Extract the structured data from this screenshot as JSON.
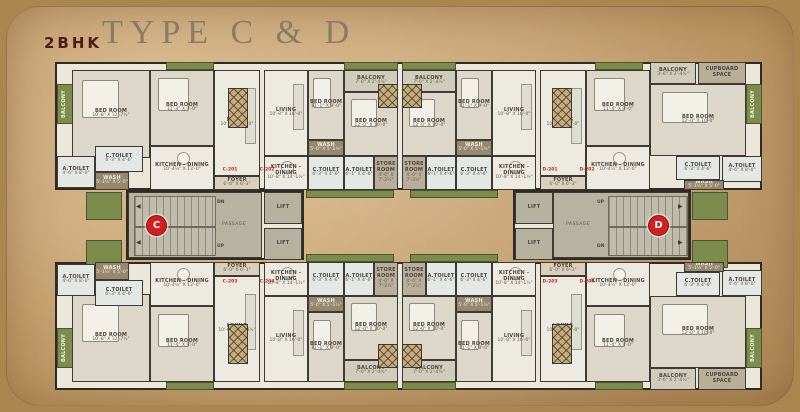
{
  "header": {
    "bhk": "2BHK",
    "type_title": "TYPE C & D"
  },
  "colors": {
    "paper": "#cba878",
    "wall": "#3e3933",
    "green": "#7c8c4c",
    "badge_red": "#d21f1f",
    "flat_red": "#c0241e",
    "title_maroon": "#4d1d14",
    "title_serif": "#8b7a66"
  },
  "plan": {
    "lift_label": "LIFT",
    "slabs": [
      {
        "x": 55,
        "y": 62,
        "w": 707,
        "h": 128
      },
      {
        "x": 55,
        "y": 262,
        "w": 707,
        "h": 128
      },
      {
        "x": 126,
        "y": 190,
        "w": 178,
        "h": 70
      },
      {
        "x": 513,
        "y": 190,
        "w": 178,
        "h": 70
      }
    ],
    "rooms": [
      {
        "type": "balcony-v",
        "label": "BALCONY",
        "dims": "3'-6\" X 1'-10½\"",
        "x": 57,
        "y": 84,
        "w": 16,
        "h": 40
      },
      {
        "type": "bed",
        "label": "BED ROOM",
        "dims": "10'-8\" X 12'-7½\"",
        "x": 72,
        "y": 70,
        "w": 78,
        "h": 88
      },
      {
        "type": "bed",
        "label": "BED ROOM",
        "dims": "11'-4\" X 9'-0\"",
        "x": 150,
        "y": 70,
        "w": 64,
        "h": 76
      },
      {
        "type": "living",
        "label": "LIVING",
        "dims": "10'-8\" X 16'-0\"",
        "x": 214,
        "y": 70,
        "w": 46,
        "h": 106
      },
      {
        "type": "toilet",
        "label": "A.TOILET",
        "dims": "4'-6\" X 8'-0\"",
        "x": 57,
        "y": 156,
        "w": 38,
        "h": 32
      },
      {
        "type": "toilet",
        "label": "C.TOILET",
        "dims": "6'-3\" X 4'-6\"",
        "x": 95,
        "y": 146,
        "w": 48,
        "h": 26
      },
      {
        "type": "wash",
        "label": "WASH",
        "dims": "5'-1½\" X 5'-0\"",
        "x": 95,
        "y": 172,
        "w": 34,
        "h": 18
      },
      {
        "type": "kitchen",
        "label": "KITCHEN - DINING",
        "dims": "10'-4½\" X 13'-0\"",
        "x": 150,
        "y": 146,
        "w": 64,
        "h": 44
      },
      {
        "type": "foyer",
        "label": "FOYER",
        "dims": "6'-0\" X 6'-3\"",
        "x": 214,
        "y": 176,
        "w": 46,
        "h": 14
      },
      {
        "type": "living",
        "label": "LIVING",
        "dims": "10'-8\" X 16'-0\"",
        "x": 264,
        "y": 70,
        "w": 44,
        "h": 86
      },
      {
        "type": "bed",
        "label": "BED ROOM",
        "dims": "11'-1\" X 9'-0\"",
        "x": 308,
        "y": 70,
        "w": 36,
        "h": 70
      },
      {
        "type": "wash",
        "label": "WASH",
        "dims": "5'-0\" X 5'-1½\"",
        "x": 308,
        "y": 140,
        "w": 36,
        "h": 16
      },
      {
        "type": "balcony",
        "label": "BALCONY",
        "dims": "7'-0\" X 2'-4½\"",
        "x": 344,
        "y": 70,
        "w": 54,
        "h": 22
      },
      {
        "type": "bed",
        "label": "BED ROOM",
        "dims": "12'-0\" X 10'-0\"",
        "x": 344,
        "y": 92,
        "w": 54,
        "h": 64
      },
      {
        "type": "kitchen",
        "label": "KITCHEN - DINING",
        "dims": "10'-8\" X 14'-1½\"",
        "x": 264,
        "y": 156,
        "w": 44,
        "h": 34
      },
      {
        "type": "toilet",
        "label": "C.TOILET",
        "dims": "6'-3\" X 4'-6\"",
        "x": 308,
        "y": 156,
        "w": 36,
        "h": 34
      },
      {
        "type": "toilet",
        "label": "A.TOILET",
        "dims": "6'-1\" X 4'-6\"",
        "x": 344,
        "y": 156,
        "w": 30,
        "h": 34
      },
      {
        "type": "store",
        "label": "STORE ROOM",
        "dims": "4'-0\" X 7'-2½\"",
        "x": 374,
        "y": 156,
        "w": 24,
        "h": 34
      },
      {
        "type": "balcony",
        "label": "BALCONY",
        "dims": "7'-0\" X 2'-4½\"",
        "x": 402,
        "y": 70,
        "w": 54,
        "h": 22
      },
      {
        "type": "bed",
        "label": "BED ROOM",
        "dims": "12'-0\" X 10'-0\"",
        "x": 402,
        "y": 92,
        "w": 54,
        "h": 64
      },
      {
        "type": "bed",
        "label": "BED ROOM",
        "dims": "11'-1\" X 9'-0\"",
        "x": 456,
        "y": 70,
        "w": 36,
        "h": 70
      },
      {
        "type": "wash",
        "label": "WASH",
        "dims": "5'-0\" X 5'-1½\"",
        "x": 456,
        "y": 140,
        "w": 36,
        "h": 16
      },
      {
        "type": "living",
        "label": "LIVING",
        "dims": "10'-8\" X 16'-0\"",
        "x": 492,
        "y": 70,
        "w": 44,
        "h": 86
      },
      {
        "type": "store",
        "label": "STORE ROOM",
        "dims": "4'-0\" X 7'-2½\"",
        "x": 402,
        "y": 156,
        "w": 24,
        "h": 34
      },
      {
        "type": "toilet",
        "label": "A.TOILET",
        "dims": "6'-1\" X 4'-6\"",
        "x": 426,
        "y": 156,
        "w": 30,
        "h": 34
      },
      {
        "type": "toilet",
        "label": "C.TOILET",
        "dims": "6'-3\" X 4'-6\"",
        "x": 456,
        "y": 156,
        "w": 36,
        "h": 34
      },
      {
        "type": "kitchen",
        "label": "KITCHEN - DINING",
        "dims": "10'-8\" X 14'-1½\"",
        "x": 492,
        "y": 156,
        "w": 44,
        "h": 34
      },
      {
        "type": "living",
        "label": "LIVING",
        "dims": "10'-8\" X 16'-0\"",
        "x": 540,
        "y": 70,
        "w": 46,
        "h": 106
      },
      {
        "type": "foyer",
        "label": "FOYER",
        "dims": "6'-0\" X 6'-3\"",
        "x": 540,
        "y": 176,
        "w": 46,
        "h": 14
      },
      {
        "type": "bed",
        "label": "BED ROOM",
        "dims": "11'-4\" X 9'-0\"",
        "x": 586,
        "y": 70,
        "w": 64,
        "h": 76
      },
      {
        "type": "kitchen",
        "label": "KITCHEN - DINING",
        "dims": "10'-4½\" X 13'-0\"",
        "x": 586,
        "y": 146,
        "w": 64,
        "h": 44
      },
      {
        "type": "balcony",
        "label": "BALCONY",
        "dims": "3'-6\" X 2'-4½\"",
        "x": 650,
        "y": 62,
        "w": 46,
        "h": 22
      },
      {
        "type": "store",
        "label": "CUPBOARD SPACE",
        "dims": "",
        "x": 698,
        "y": 62,
        "w": 48,
        "h": 22
      },
      {
        "type": "bed",
        "label": "BED ROOM",
        "dims": "12'-0\" X 10'-0\"",
        "x": 650,
        "y": 84,
        "w": 96,
        "h": 72
      },
      {
        "type": "toilet",
        "label": "C.TOILET",
        "dims": "6'-3\" X 4'-6\"",
        "x": 676,
        "y": 156,
        "w": 44,
        "h": 24
      },
      {
        "type": "toilet",
        "label": "A.TOILET",
        "dims": "4'-6\" X 8'-0\"",
        "x": 722,
        "y": 156,
        "w": 40,
        "h": 26
      },
      {
        "type": "wash",
        "label": "WASH",
        "dims": "5'-1½\" X 5'-0\"",
        "x": 684,
        "y": 180,
        "w": 40,
        "h": 10
      },
      {
        "type": "balcony-v",
        "label": "BALCONY",
        "dims": "3'-6\" X 1'-10½\"",
        "x": 746,
        "y": 84,
        "w": 16,
        "h": 40
      },
      {
        "type": "balcony-v",
        "label": "BALCONY",
        "dims": "3'-6\" X 1'-10½\"",
        "x": 57,
        "y": 328,
        "w": 16,
        "h": 40
      },
      {
        "type": "bed",
        "label": "BED ROOM",
        "dims": "10'-8\" X 12'-7½\"",
        "x": 72,
        "y": 294,
        "w": 78,
        "h": 88
      },
      {
        "type": "bed",
        "label": "BED ROOM",
        "dims": "11'-4\" X 9'-0\"",
        "x": 150,
        "y": 306,
        "w": 64,
        "h": 76
      },
      {
        "type": "living",
        "label": "LIVING",
        "dims": "10'-8\" X 16'-4½\"",
        "x": 214,
        "y": 276,
        "w": 46,
        "h": 106
      },
      {
        "type": "toilet",
        "label": "A.TOILET",
        "dims": "4'-6\" X 8'-0\"",
        "x": 57,
        "y": 264,
        "w": 38,
        "h": 32
      },
      {
        "type": "toilet",
        "label": "C.TOILET",
        "dims": "6'-3\" X 4'-6\"",
        "x": 95,
        "y": 280,
        "w": 48,
        "h": 26
      },
      {
        "type": "wash",
        "label": "WASH",
        "dims": "5'-1½\" X 5'-0\"",
        "x": 95,
        "y": 262,
        "w": 34,
        "h": 18
      },
      {
        "type": "kitchen",
        "label": "KITCHEN - DINING",
        "dims": "10'-4½\" X 13'-0\"",
        "x": 150,
        "y": 262,
        "w": 64,
        "h": 44
      },
      {
        "type": "foyer",
        "label": "FOYER",
        "dims": "6'-0\" X 6'-3\"",
        "x": 214,
        "y": 262,
        "w": 46,
        "h": 14
      },
      {
        "type": "living",
        "label": "LIVING",
        "dims": "10'-8\" X 16'-0\"",
        "x": 264,
        "y": 296,
        "w": 44,
        "h": 86
      },
      {
        "type": "bed",
        "label": "BED ROOM",
        "dims": "11'-1\" X 9'-0\"",
        "x": 308,
        "y": 312,
        "w": 36,
        "h": 70
      },
      {
        "type": "wash",
        "label": "WASH",
        "dims": "5'-0\" X 5'-1½\"",
        "x": 308,
        "y": 296,
        "w": 36,
        "h": 16
      },
      {
        "type": "balcony",
        "label": "BALCONY",
        "dims": "7'-0\" X 2'-4½\"",
        "x": 344,
        "y": 360,
        "w": 54,
        "h": 22
      },
      {
        "type": "bed",
        "label": "BED ROOM",
        "dims": "12'-0\" X 10'-0\"",
        "x": 344,
        "y": 296,
        "w": 54,
        "h": 64
      },
      {
        "type": "kitchen",
        "label": "KITCHEN - DINING",
        "dims": "10'-8\" X 14'-1½\"",
        "x": 264,
        "y": 262,
        "w": 44,
        "h": 34
      },
      {
        "type": "toilet",
        "label": "C.TOILET",
        "dims": "6'-3\" X 4'-6\"",
        "x": 308,
        "y": 262,
        "w": 36,
        "h": 34
      },
      {
        "type": "toilet",
        "label": "A.TOILET",
        "dims": "6'-1\" X 4'-6\"",
        "x": 344,
        "y": 262,
        "w": 30,
        "h": 34
      },
      {
        "type": "store",
        "label": "STORE ROOM",
        "dims": "4'-0\" X 7'-2½\"",
        "x": 374,
        "y": 262,
        "w": 24,
        "h": 34
      },
      {
        "type": "balcony",
        "label": "BALCONY",
        "dims": "7'-0\" X 2'-4½\"",
        "x": 402,
        "y": 360,
        "w": 54,
        "h": 22
      },
      {
        "type": "bed",
        "label": "BED ROOM",
        "dims": "12'-0\" X 10'-0\"",
        "x": 402,
        "y": 296,
        "w": 54,
        "h": 64
      },
      {
        "type": "bed",
        "label": "BED ROOM",
        "dims": "11'-1\" X 9'-0\"",
        "x": 456,
        "y": 312,
        "w": 36,
        "h": 70
      },
      {
        "type": "wash",
        "label": "WASH",
        "dims": "5'-0\" X 5'-1½\"",
        "x": 456,
        "y": 296,
        "w": 36,
        "h": 16
      },
      {
        "type": "living",
        "label": "LIVING",
        "dims": "10'-8\" X 16'-0\"",
        "x": 492,
        "y": 296,
        "w": 44,
        "h": 86
      },
      {
        "type": "store",
        "label": "STORE ROOM",
        "dims": "4'-0\" X 7'-2½\"",
        "x": 402,
        "y": 262,
        "w": 24,
        "h": 34
      },
      {
        "type": "toilet",
        "label": "A.TOILET",
        "dims": "6'-1\" X 4'-6\"",
        "x": 426,
        "y": 262,
        "w": 30,
        "h": 34
      },
      {
        "type": "toilet",
        "label": "C.TOILET",
        "dims": "6'-3\" X 4'-6\"",
        "x": 456,
        "y": 262,
        "w": 36,
        "h": 34
      },
      {
        "type": "kitchen",
        "label": "KITCHEN - DINING",
        "dims": "10'-8\" X 14'-1½\"",
        "x": 492,
        "y": 262,
        "w": 44,
        "h": 34
      },
      {
        "type": "living",
        "label": "LIVING",
        "dims": "10'-8\" X 16'-0\"",
        "x": 540,
        "y": 276,
        "w": 46,
        "h": 106
      },
      {
        "type": "foyer",
        "label": "FOYER",
        "dims": "6'-0\" X 6'-3\"",
        "x": 540,
        "y": 262,
        "w": 46,
        "h": 14
      },
      {
        "type": "bed",
        "label": "BED ROOM",
        "dims": "11'-4\" X 9'-0\"",
        "x": 586,
        "y": 306,
        "w": 64,
        "h": 76
      },
      {
        "type": "kitchen",
        "label": "KITCHEN - DINING",
        "dims": "10'-4½\" X 13'-0\"",
        "x": 586,
        "y": 262,
        "w": 64,
        "h": 44
      },
      {
        "type": "balcony",
        "label": "BALCONY",
        "dims": "3'-6\" X 2'-4½\"",
        "x": 650,
        "y": 368,
        "w": 46,
        "h": 22
      },
      {
        "type": "store",
        "label": "CUPBOARD SPACE",
        "dims": "",
        "x": 698,
        "y": 368,
        "w": 48,
        "h": 22
      },
      {
        "type": "bed",
        "label": "BED ROOM",
        "dims": "12'-0\" X 10'-0\"",
        "x": 650,
        "y": 296,
        "w": 96,
        "h": 72
      },
      {
        "type": "toilet",
        "label": "C.TOILET",
        "dims": "6'-3\" X 4'-6\"",
        "x": 676,
        "y": 272,
        "w": 44,
        "h": 24
      },
      {
        "type": "toilet",
        "label": "A.TOILET",
        "dims": "4'-6\" X 8'-0\"",
        "x": 722,
        "y": 270,
        "w": 40,
        "h": 26
      },
      {
        "type": "wash",
        "label": "WASH",
        "dims": "5'-1½\" X 5'-0\"",
        "x": 684,
        "y": 262,
        "w": 40,
        "h": 10
      },
      {
        "type": "balcony-v",
        "label": "BALCONY",
        "dims": "3'-6\" X 1'-10½\"",
        "x": 746,
        "y": 328,
        "w": 16,
        "h": 40
      }
    ],
    "lifts": [
      {
        "x": 264,
        "y": 192,
        "w": 38,
        "h": 32
      },
      {
        "x": 264,
        "y": 228,
        "w": 38,
        "h": 32
      },
      {
        "x": 515,
        "y": 192,
        "w": 38,
        "h": 32
      },
      {
        "x": 515,
        "y": 228,
        "w": 38,
        "h": 32
      }
    ],
    "cores": [
      {
        "x": 128,
        "y": 192,
        "w": 134,
        "h": 66,
        "stair_x": 134,
        "stair_y": 196,
        "stair_w": 80,
        "stair_h": 58,
        "passage": "PASSAGE",
        "passage_x": 222,
        "passage_y": 222,
        "top_label": "DN",
        "bot_label": "UP",
        "label_x": 217,
        "arrow": "◀",
        "arrow_x": 136,
        "badge": "C",
        "badge_x": 146,
        "badge_y": 215
      },
      {
        "x": 553,
        "y": 192,
        "w": 136,
        "h": 66,
        "stair_x": 608,
        "stair_y": 196,
        "stair_w": 78,
        "stair_h": 58,
        "passage": "PASSAGE",
        "passage_x": 566,
        "passage_y": 222,
        "top_label": "UP",
        "bot_label": "DN",
        "label_x": 597,
        "arrow": "▶",
        "arrow_x": 678,
        "badge": "D",
        "badge_x": 648,
        "badge_y": 215
      }
    ],
    "planters": [
      {
        "x": 166,
        "y": 62,
        "w": 48,
        "h": 8
      },
      {
        "x": 344,
        "y": 62,
        "w": 54,
        "h": 8
      },
      {
        "x": 402,
        "y": 62,
        "w": 54,
        "h": 8
      },
      {
        "x": 595,
        "y": 62,
        "w": 48,
        "h": 8
      },
      {
        "x": 166,
        "y": 382,
        "w": 48,
        "h": 8
      },
      {
        "x": 344,
        "y": 382,
        "w": 54,
        "h": 8
      },
      {
        "x": 402,
        "y": 382,
        "w": 54,
        "h": 8
      },
      {
        "x": 595,
        "y": 382,
        "w": 48,
        "h": 8
      },
      {
        "x": 86,
        "y": 192,
        "w": 36,
        "h": 28
      },
      {
        "x": 86,
        "y": 240,
        "w": 36,
        "h": 28
      },
      {
        "x": 692,
        "y": 192,
        "w": 36,
        "h": 28
      },
      {
        "x": 692,
        "y": 240,
        "w": 36,
        "h": 28
      },
      {
        "x": 306,
        "y": 190,
        "w": 88,
        "h": 8
      },
      {
        "x": 410,
        "y": 190,
        "w": 88,
        "h": 8
      },
      {
        "x": 306,
        "y": 254,
        "w": 88,
        "h": 8
      },
      {
        "x": 410,
        "y": 254,
        "w": 88,
        "h": 8
      }
    ],
    "shafts": [
      {
        "x": 378,
        "y": 84,
        "w": 20,
        "h": 24
      },
      {
        "x": 402,
        "y": 84,
        "w": 20,
        "h": 24
      },
      {
        "x": 228,
        "y": 88,
        "w": 20,
        "h": 40
      },
      {
        "x": 552,
        "y": 88,
        "w": 20,
        "h": 40
      },
      {
        "x": 378,
        "y": 344,
        "w": 20,
        "h": 24
      },
      {
        "x": 402,
        "y": 344,
        "w": 20,
        "h": 24
      },
      {
        "x": 228,
        "y": 324,
        "w": 20,
        "h": 40
      },
      {
        "x": 552,
        "y": 324,
        "w": 20,
        "h": 40
      }
    ],
    "flat_labels": [
      {
        "text": "C-201",
        "x": 230,
        "y": 170
      },
      {
        "text": "C-202",
        "x": 267,
        "y": 170
      },
      {
        "text": "C-203",
        "x": 230,
        "y": 282
      },
      {
        "text": "C-204",
        "x": 267,
        "y": 282
      },
      {
        "text": "D-201",
        "x": 550,
        "y": 170
      },
      {
        "text": "D-202",
        "x": 587,
        "y": 170
      },
      {
        "text": "D-203",
        "x": 550,
        "y": 282
      },
      {
        "text": "D-204",
        "x": 587,
        "y": 282
      }
    ]
  }
}
